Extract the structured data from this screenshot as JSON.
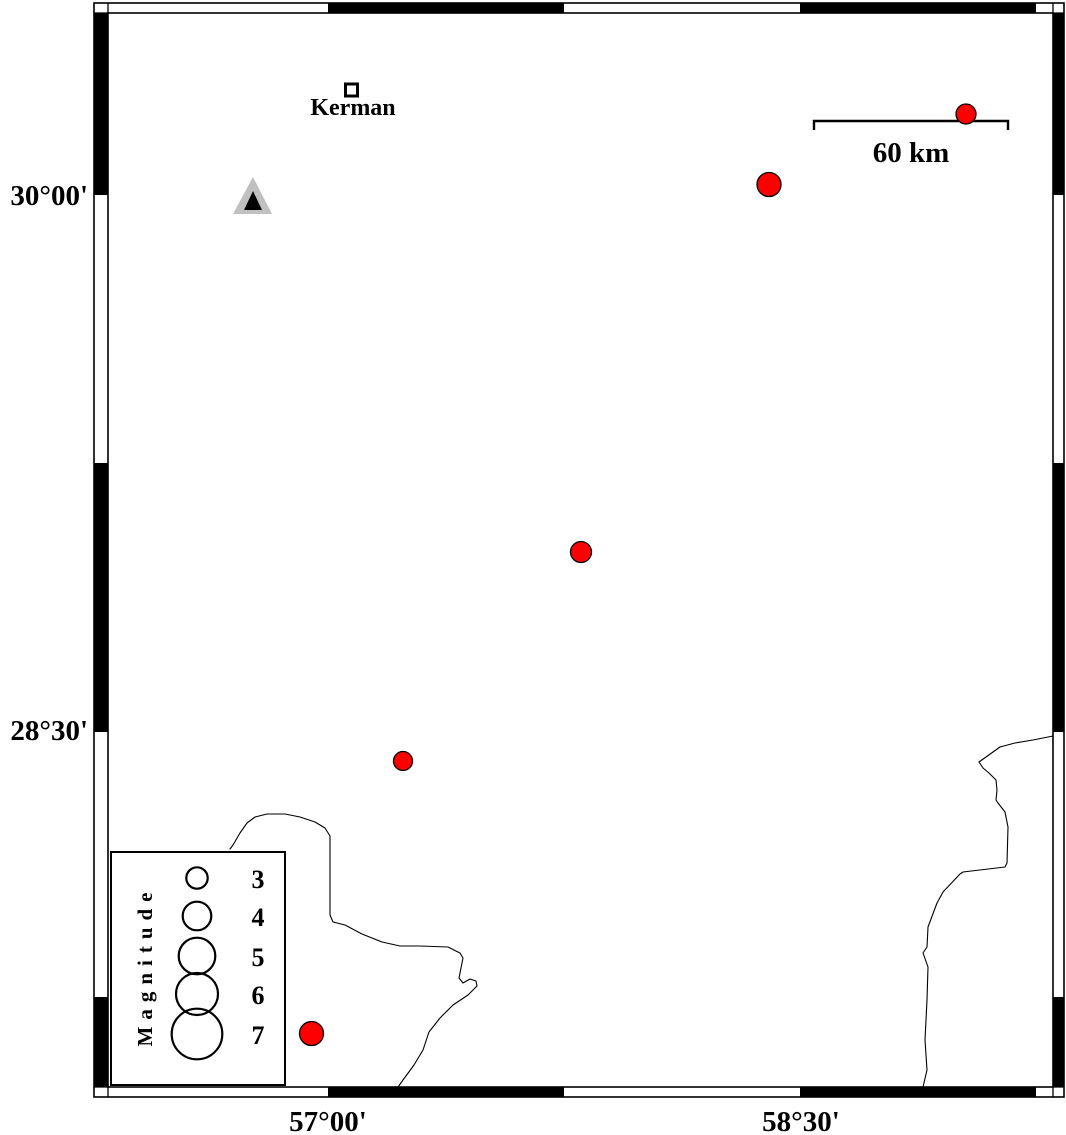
{
  "figure": {
    "width": 1066,
    "height": 1135,
    "background": "#ffffff"
  },
  "colors": {
    "earthquake_fill": "#ff0000",
    "marker_outline": "#000000",
    "triangle_fill": "#c0c0c0",
    "triangle_core": "#000000",
    "coastline": "#000000",
    "frame": "#000000"
  },
  "map_frame": {
    "outer": {
      "x1": 94,
      "y1": 3,
      "x2": 1064,
      "y2": 1097
    },
    "inner": {
      "x1": 108,
      "y1": 13,
      "x2": 1053,
      "y2": 1087
    },
    "black_segments_x": [
      [
        328,
        564
      ],
      [
        800,
        1036
      ]
    ],
    "black_segments_y": [
      [
        13,
        195
      ],
      [
        463,
        732
      ],
      [
        997,
        1087
      ]
    ]
  },
  "axes": {
    "left_labels": [
      {
        "text": "30°00'",
        "y": 195
      },
      {
        "text": "28°30'",
        "y": 730
      }
    ],
    "bottom_labels": [
      {
        "text": "57°00'",
        "x": 328
      },
      {
        "text": "58°30'",
        "x": 801
      }
    ]
  },
  "scale_bar": {
    "label": "60 km",
    "x1": 814,
    "x2": 1008,
    "y": 121,
    "tick_drop": 9
  },
  "city": {
    "label": "Kerman",
    "marker": {
      "x": 351.5,
      "y": 90,
      "size": 12,
      "border": 3
    }
  },
  "station_triangle": {
    "outer_points": [
      [
        253,
        177
      ],
      [
        233,
        214
      ],
      [
        272,
        214
      ]
    ],
    "core_points": [
      [
        253,
        191
      ],
      [
        244,
        210
      ],
      [
        262,
        210
      ]
    ]
  },
  "earthquakes": [
    {
      "x": 966,
      "y": 114,
      "r": 10
    },
    {
      "x": 769,
      "y": 184.5,
      "r": 12
    },
    {
      "x": 581,
      "y": 552,
      "r": 10.5
    },
    {
      "x": 403,
      "y": 761,
      "r": 9.5
    },
    {
      "x": 311.5,
      "y": 1033.5,
      "r": 12
    }
  ],
  "legend": {
    "title": "Magnitude",
    "box": {
      "x1": 111,
      "y1": 852,
      "x2": 285,
      "y2": 1085
    },
    "circles_cx": 197,
    "labels_x": 258,
    "entries": [
      {
        "label": "3",
        "cy": 878,
        "r": 10.7
      },
      {
        "label": "4",
        "cy": 916,
        "r": 14.3
      },
      {
        "label": "5",
        "cy": 956,
        "r": 18.3
      },
      {
        "label": "6",
        "cy": 994,
        "r": 21.0
      },
      {
        "label": "7",
        "cy": 1034,
        "r": 25.3
      }
    ]
  },
  "coastlines": [
    {
      "name": "coastline-left",
      "points": [
        [
          230,
          849
        ],
        [
          233,
          845
        ],
        [
          240,
          833
        ],
        [
          247,
          823
        ],
        [
          255,
          817
        ],
        [
          267,
          814
        ],
        [
          285,
          814
        ],
        [
          300,
          817
        ],
        [
          315,
          822
        ],
        [
          325,
          828
        ],
        [
          330,
          836
        ],
        [
          330,
          915
        ],
        [
          333,
          922
        ],
        [
          345,
          925
        ],
        [
          362,
          934
        ],
        [
          382,
          942
        ],
        [
          400,
          946
        ],
        [
          420,
          946
        ],
        [
          448,
          947
        ],
        [
          460,
          953
        ],
        [
          463,
          958
        ],
        [
          459,
          978
        ],
        [
          463,
          983
        ],
        [
          470,
          979
        ],
        [
          476,
          981
        ],
        [
          477,
          986
        ],
        [
          468,
          995
        ],
        [
          453,
          1005
        ],
        [
          440,
          1018
        ],
        [
          429,
          1032
        ],
        [
          423,
          1050
        ],
        [
          414,
          1065
        ],
        [
          403,
          1080
        ],
        [
          398,
          1087
        ]
      ]
    },
    {
      "name": "coastline-right",
      "points": [
        [
          1053,
          736
        ],
        [
          1033,
          740
        ],
        [
          1015,
          743
        ],
        [
          1000,
          747
        ],
        [
          979,
          762
        ],
        [
          983,
          768
        ],
        [
          989,
          773
        ],
        [
          996,
          780
        ],
        [
          997,
          790
        ],
        [
          996,
          800
        ],
        [
          998,
          803
        ],
        [
          1005,
          812
        ],
        [
          1008,
          827
        ],
        [
          1007,
          863
        ],
        [
          1005,
          867
        ],
        [
          963,
          872
        ],
        [
          960,
          874
        ],
        [
          943,
          892
        ],
        [
          937,
          903
        ],
        [
          928,
          927
        ],
        [
          927,
          947
        ],
        [
          923,
          953
        ],
        [
          928,
          967
        ],
        [
          927,
          1000
        ],
        [
          925,
          1040
        ],
        [
          927,
          1070
        ],
        [
          923,
          1087
        ]
      ]
    }
  ]
}
